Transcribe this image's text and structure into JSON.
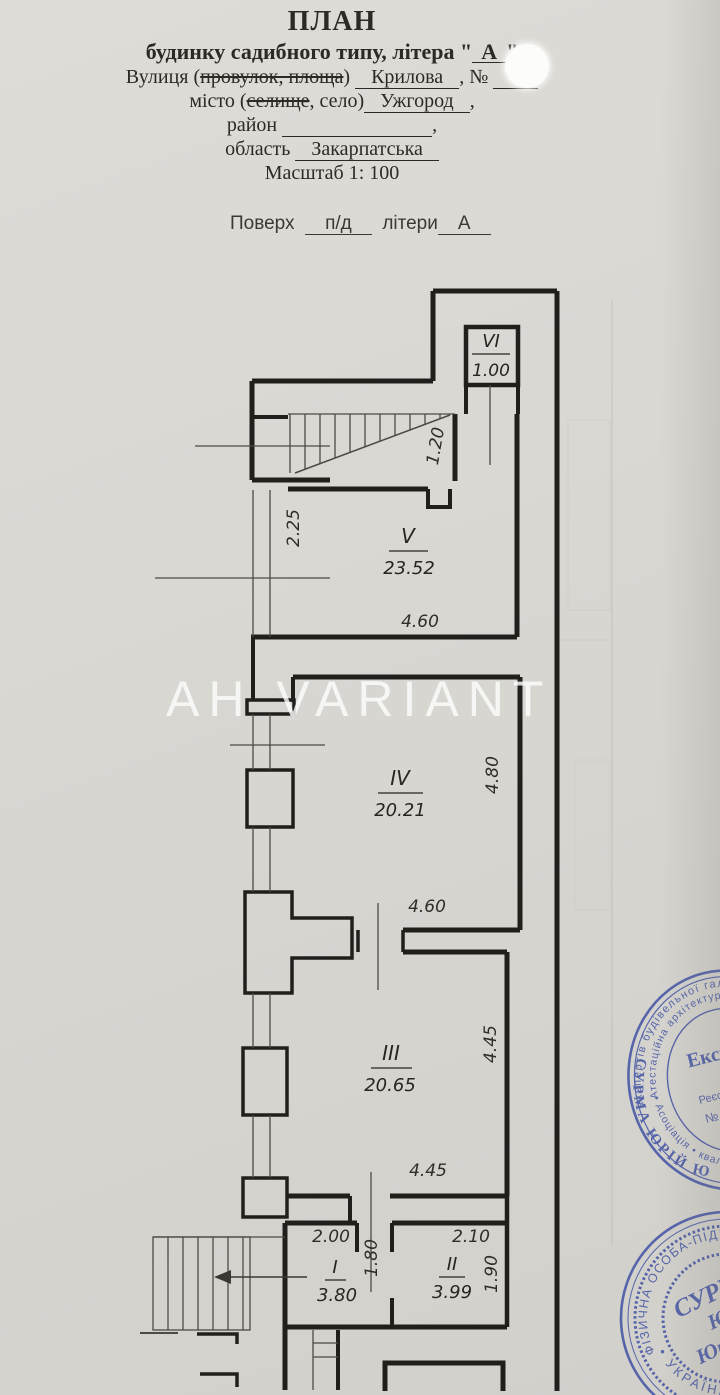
{
  "header": {
    "title": "ПЛАН",
    "subtitle_prefix": "будинку садибного типу, літера \"",
    "letter": "А",
    "subtitle_suffix": "\"",
    "street_label1": "Вулиця (",
    "street_struck": "провулок, площа",
    "street_label2": ")",
    "street_value": "Крилова",
    "street_label3": ", №",
    "city_label1": "місто (",
    "city_struck": "селище",
    "city_label2": ", село)",
    "city_value": "Ужгород",
    "city_suffix": ",",
    "district_label": "район",
    "district_suffix": ",",
    "region_label": "область",
    "region_value": "Закарпатська",
    "scale": "Масштаб 1: 100",
    "floor_label": "Поверх",
    "floor_value": "п/д",
    "letters_label": "літери",
    "letters_value": "А"
  },
  "watermark": "АН VARIANT",
  "rooms": {
    "vi": {
      "num": "VI",
      "area": "1.00"
    },
    "v": {
      "num": "V",
      "area": "23.52"
    },
    "iv": {
      "num": "IV",
      "area": "20.21"
    },
    "iii": {
      "num": "III",
      "area": "20.65"
    },
    "i": {
      "num": "I",
      "area": "3.80"
    },
    "ii": {
      "num": "II",
      "area": "3.99"
    }
  },
  "dims": {
    "stair_width": "1.20",
    "v_left": "2.25",
    "v_bottom": "4.60",
    "iv_right": "4.80",
    "iv_bottom": "4.60",
    "iii_right": "4.45",
    "iii_bottom": "4.45",
    "i_top": "2.00",
    "i_right": "1.80",
    "ii_top": "2.10",
    "ii_right": "1.90"
  },
  "stamp_expert": {
    "ring_outer": "експертів будівельної галузі • атестаці",
    "ring_inner": "Атестаційна архітектур • «УКРАЇН",
    "ring_bottom": "• Асоціація • кваліфікаційний сертифі",
    "title": "Експерт",
    "reg1": "Реєстраційн",
    "reg2": "№ 39",
    "name": "СУРМА ЮРІЙ Ю"
  },
  "stamp_fop": {
    "ring_top": "ФІЗИЧНА ОСОБА-ПІДПРИЄМЕЦЬ",
    "ring_bottom": "• УКРАЇНА •",
    "surname": "СУРМА",
    "first": "Юрій",
    "patronymic": "Юрійович",
    "code_label": "код",
    "code": "304461"
  },
  "colors": {
    "paper": "#d9d7d2",
    "ink": "#211f1c",
    "stamp_blue": "#3b4da3"
  }
}
